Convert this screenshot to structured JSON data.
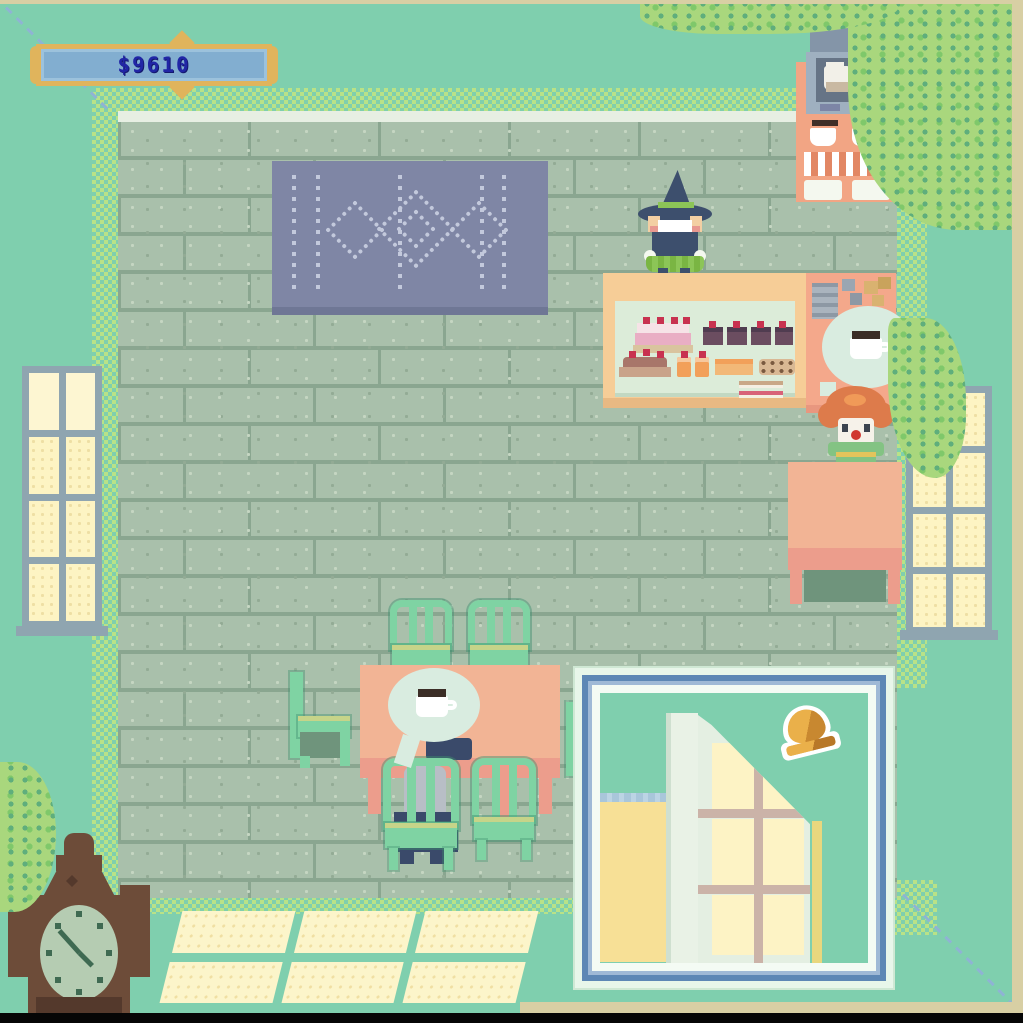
{
  "hud": {
    "money": "$9610",
    "money_text_color": "#2126a6",
    "banner_fill": "#82aed0",
    "banner_border": "#e0b45c"
  },
  "scene": {
    "background_color": "#7fcfae",
    "floor_brick_color": "#a9c0ab",
    "accent_dither_color": "#b9e287",
    "window_pane_color": "#fdf4c3",
    "table_color": "#f2b495",
    "chair_color": "#7fd3a3",
    "rug_color": "#7f86a5"
  },
  "icons": {
    "order_bubble_register": "coffee-cup-icon",
    "order_bubble_table": "coffee-cup-icon",
    "notification": "bell-icon",
    "clock": "grandfather-clock"
  },
  "characters": {
    "shopkeeper": "witch-green-skirt",
    "customer_at_register": "clown-orange-hair",
    "customer_seated": "navy-gray-hair"
  },
  "notification": {
    "type": "door-opened",
    "bell_color": "#eab04a",
    "frame_color": "#5d87b5"
  }
}
